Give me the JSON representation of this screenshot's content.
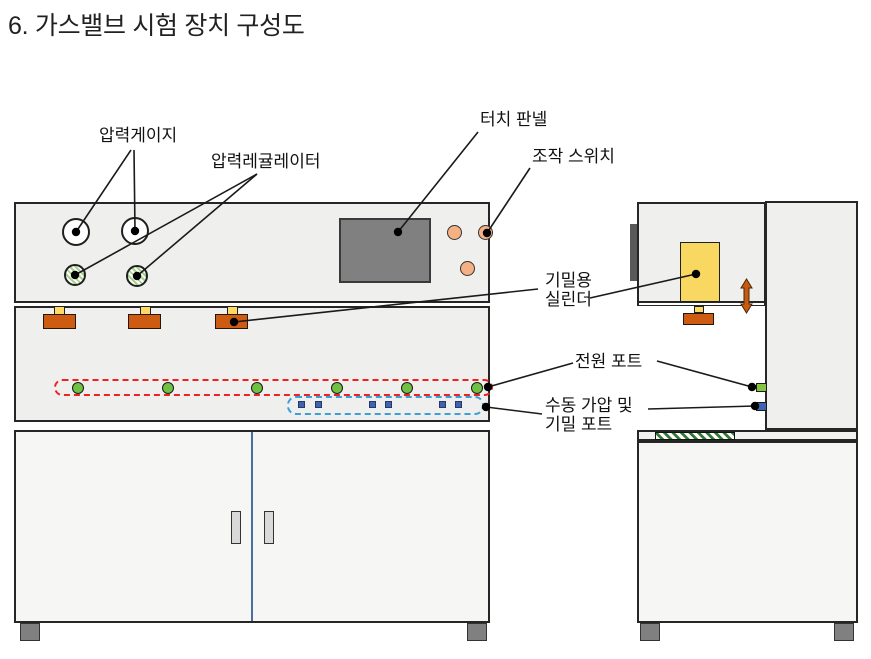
{
  "title": "6. 가스밸브 시험 장치 구성도",
  "callouts": {
    "pressure_gauge": "압력게이지",
    "pressure_regulator": "압력레귤레이터",
    "touch_panel": "터치 판넬",
    "operation_switch": "조작 스위치",
    "sealing_cylinder": {
      "line1": "기밀용",
      "line2": "실린더"
    },
    "power_port": "전원 포트",
    "manual_pressure_port": {
      "line1": "수동 가압 및",
      "line2": "기밀 포트"
    }
  },
  "diagram": {
    "front_view": {
      "pressure_gauge_count": 2,
      "pressure_regulator_count": 2,
      "operation_switch_count": 3,
      "valve_fixture_count": 3,
      "green_test_port_count": 6,
      "blue_manual_port_count": 6,
      "door_count": 2
    },
    "side_view": {
      "sealing_cylinder_count": 1,
      "power_port_count": 1,
      "manual_port_count": 1
    }
  },
  "icons": {
    "motion_arrow": "vertical-double-arrow-icon"
  },
  "colors": {
    "panel_fill": "#efefed",
    "cabinet_fill": "#f6f6f4",
    "outline": "#262626",
    "touch_panel_fill": "#808080",
    "switch_fill": "#f4b183",
    "valve_block_fill": "#cd5b12",
    "valve_stem_fill": "#ffd966",
    "cylinder_fill": "#f9d861",
    "motion_arrow_fill": "#c55a11",
    "test_port_green": "#70c043",
    "manual_port_blue": "#3f63b0",
    "red_dashed_outline": "#ee2222",
    "blue_dashed_outline": "#3aa0dc",
    "regulator_hatch_green": "#a9d18e",
    "bench_hatch_green": "#2e7d32",
    "door_split_line": "#4a6f9f",
    "foot_fill": "#808080"
  }
}
